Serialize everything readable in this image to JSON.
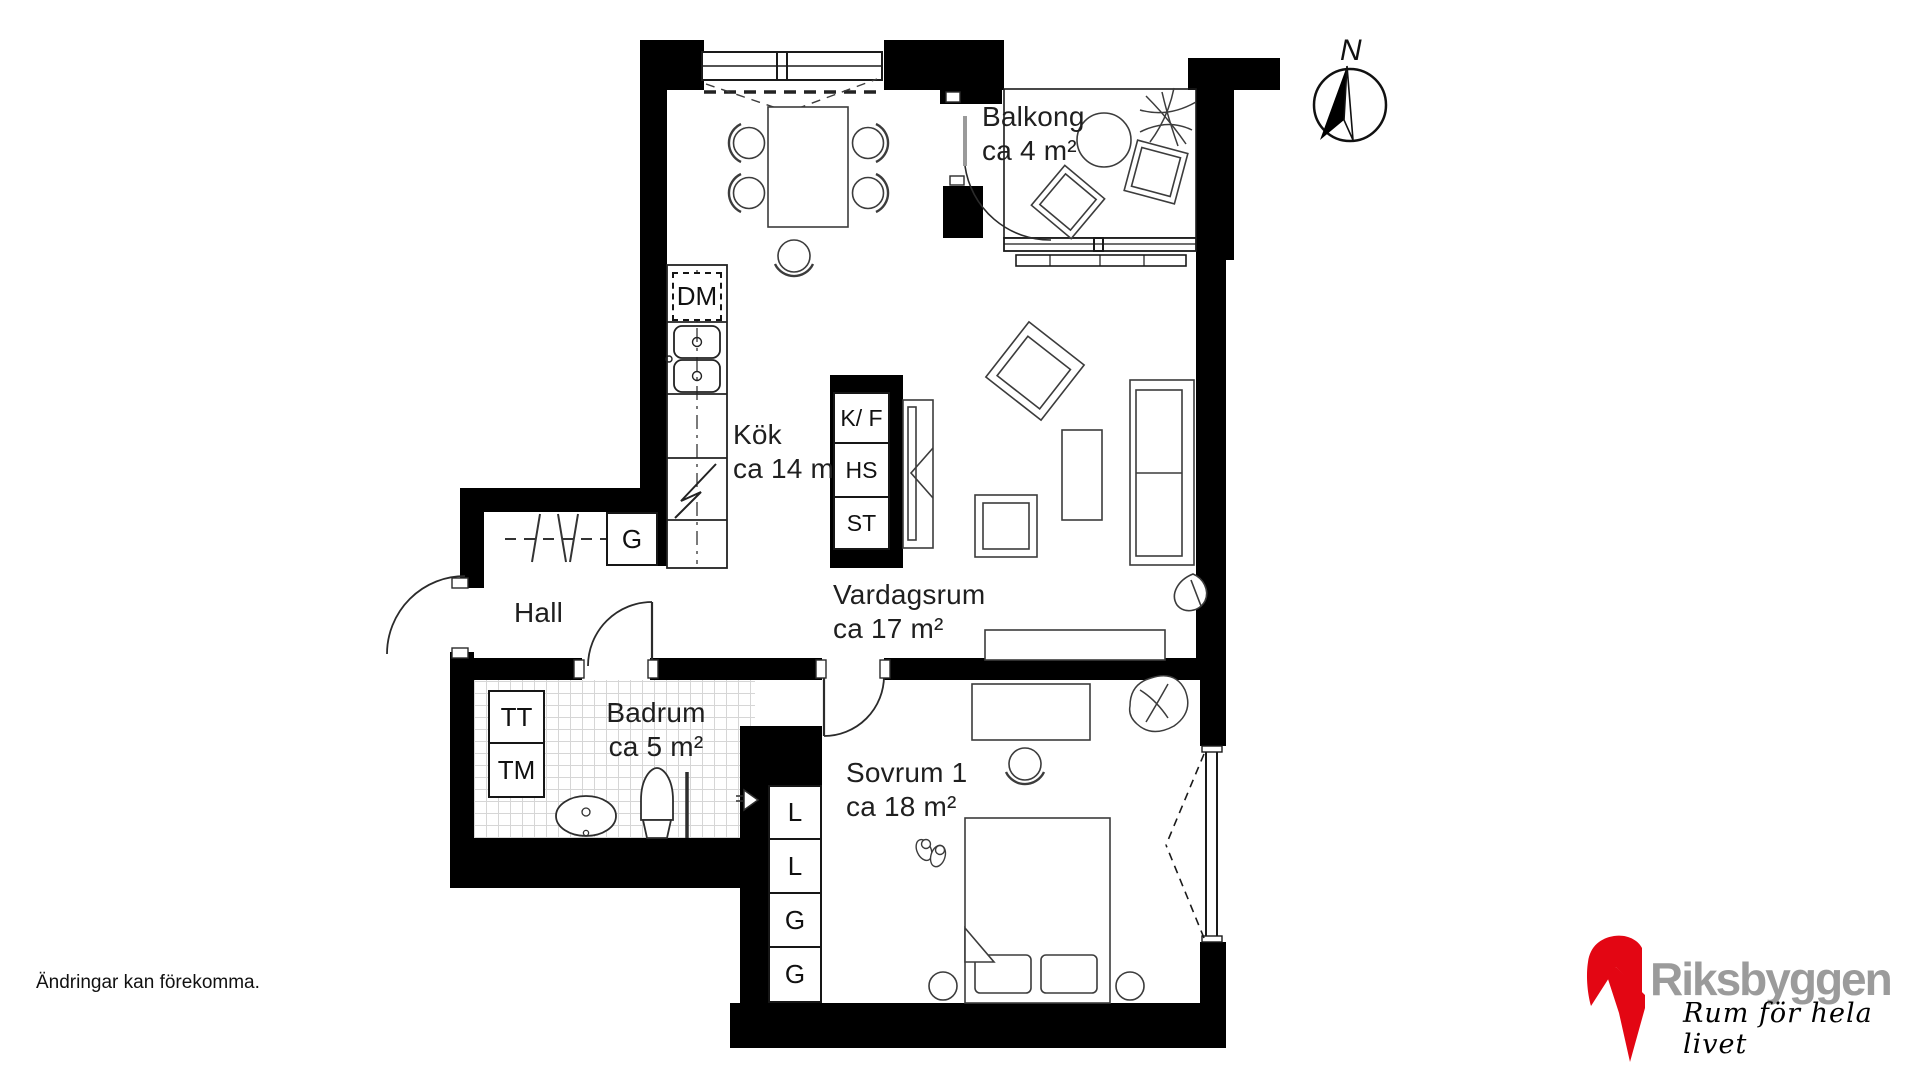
{
  "document_type": "floor-plan",
  "rooms": {
    "balkong": {
      "name": "Balkong",
      "area": "ca 4 m²"
    },
    "kok": {
      "name": "Kök",
      "area": "ca 14 m²"
    },
    "hall": {
      "name": "Hall"
    },
    "badrum": {
      "name": "Badrum",
      "area": "ca 5 m²"
    },
    "vardagsrum": {
      "name": "Vardagsrum",
      "area": "ca 17 m²"
    },
    "sovrum1": {
      "name": "Sovrum 1",
      "area": "ca 18 m²"
    }
  },
  "fixtures": {
    "dm": "DM",
    "kf": "K/ F",
    "hs": "HS",
    "st": "ST",
    "g_hall": "G",
    "tt": "TT",
    "tm": "TM",
    "closets": [
      "L",
      "L",
      "G",
      "G"
    ]
  },
  "compass": {
    "label": "N"
  },
  "footer": {
    "disclaimer": "Ändringar kan förekomma."
  },
  "brand": {
    "name": "Riksbyggen",
    "tagline": "Rum för hela livet",
    "red": "#E30613",
    "text_gray": "#9b9b9b"
  }
}
